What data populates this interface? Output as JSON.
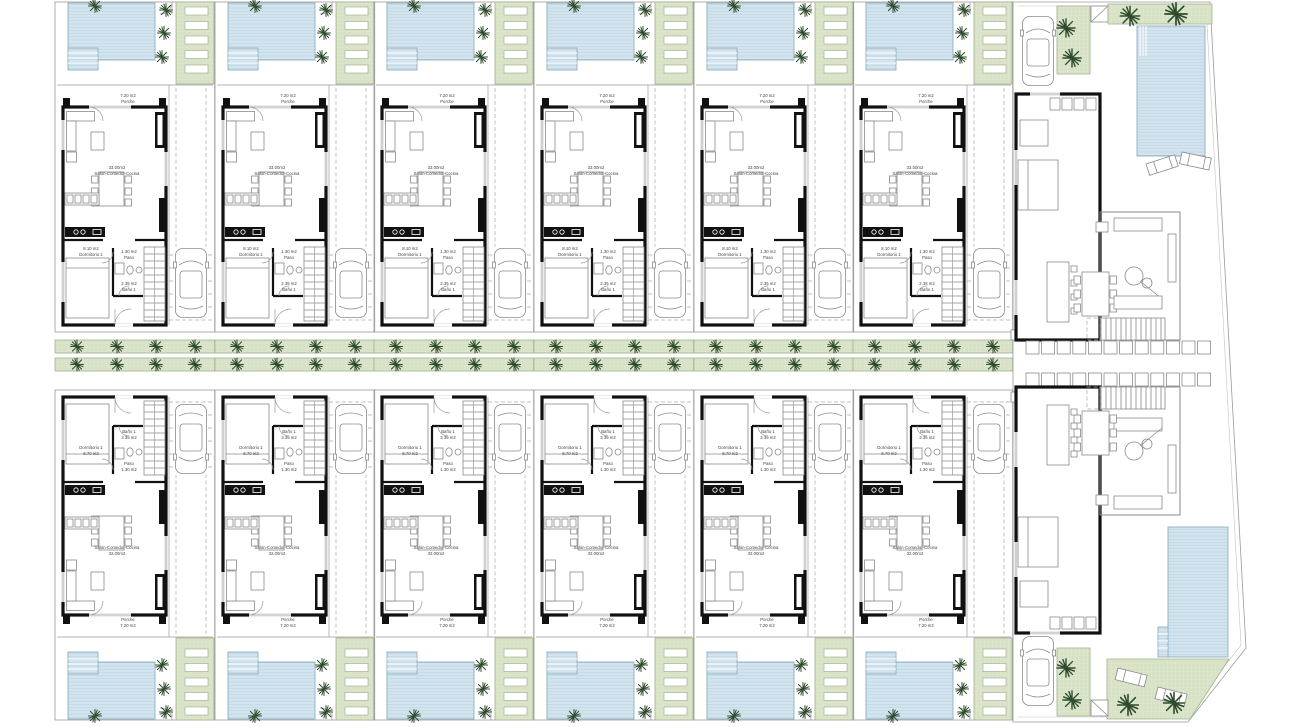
{
  "site": {
    "townhouses_top_row": 6,
    "townhouses_bottom_row": 6,
    "villas_right": 2
  },
  "units": {
    "top": {
      "porch": {
        "area": "7.20 m2",
        "name": "Porche"
      },
      "living": {
        "area": "33.00m2",
        "name": "Salón-Comedor-Cocina"
      },
      "hall": {
        "area": "1.30 m2",
        "name": "Paso"
      },
      "bedroom": {
        "area": "8.10 m2",
        "name": "Dormitorio 1"
      },
      "bath": {
        "area": "2.35 m2",
        "name": "Baño 1"
      }
    },
    "bottom": {
      "bath": {
        "name": "Baño 1",
        "area": "3.35 m2"
      },
      "bedroom": {
        "name": "Dormitorio 1",
        "area": "8.70 m2"
      },
      "hall": {
        "name": "Paso",
        "area": "1.30 m2"
      },
      "living": {
        "name": "Salón-Comedor-Cocina",
        "area": "32.00m2"
      },
      "porch": {
        "name": "Porche",
        "area": "7.20 m2"
      }
    }
  },
  "colors": {
    "pool_fill": "#d3e4ee",
    "pool_line": "#b4cfdf",
    "pool_border": "#8fb0c2",
    "grass_fill": "#dfe8d0",
    "grass_line": "#c9d7b2",
    "grass_border": "#a3b28d",
    "wall": "#111111",
    "furniture_line": "#8a8a8a",
    "plot_line": "#9a9a9a",
    "palm": "#2e4b2e",
    "text": "#444444",
    "dash": "#aaaaaa"
  }
}
